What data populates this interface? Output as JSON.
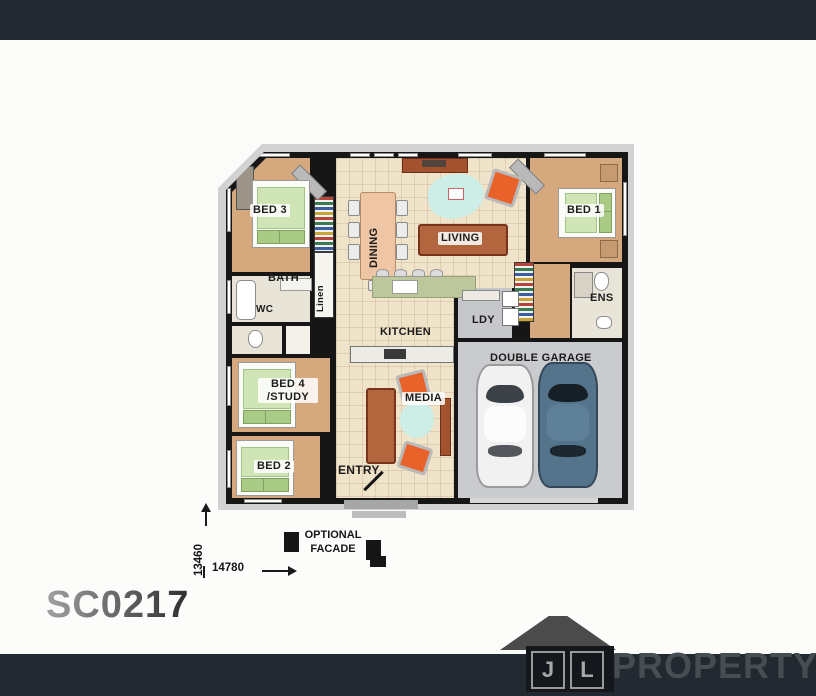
{
  "plan": {
    "code": "SC0217"
  },
  "floorplan": {
    "rooms": {
      "bed1": "BED 1",
      "bed2": "BED 2",
      "bed3": "BED 3",
      "bed4_line1": "BED 4",
      "bed4_line2": "/STUDY",
      "bath": "BATH",
      "wc": "WC",
      "linen": "Linen",
      "ens": "ENS",
      "ldy": "LDY",
      "kitchen": "KITCHEN",
      "dining": "DINING",
      "living": "LIVING",
      "media": "MEDIA",
      "entry": "ENTRY",
      "garage": "DOUBLE GARAGE"
    },
    "annotations": {
      "optional_facade_line1": "OPTIONAL",
      "optional_facade_line2": "FACADE"
    },
    "dimensions": {
      "depth": "13460",
      "width": "14780"
    }
  },
  "branding": {
    "monogram_j": "J",
    "monogram_l": "L",
    "wordmark": "PROPERTY"
  },
  "colors": {
    "bar_background": "#222931",
    "wall": "#161616",
    "bedroom_floor": "#d6a87e",
    "tile_floor": "#efe3ca",
    "garage_floor": "#cacbce",
    "rug_teal": "#cdeee6",
    "sofa_brown": "#b2663d",
    "chair_orange": "#e8622a",
    "quilt_green": "#cfe5b6",
    "car_blue": "#54748b",
    "logo_gray": "#4b4b4b"
  }
}
